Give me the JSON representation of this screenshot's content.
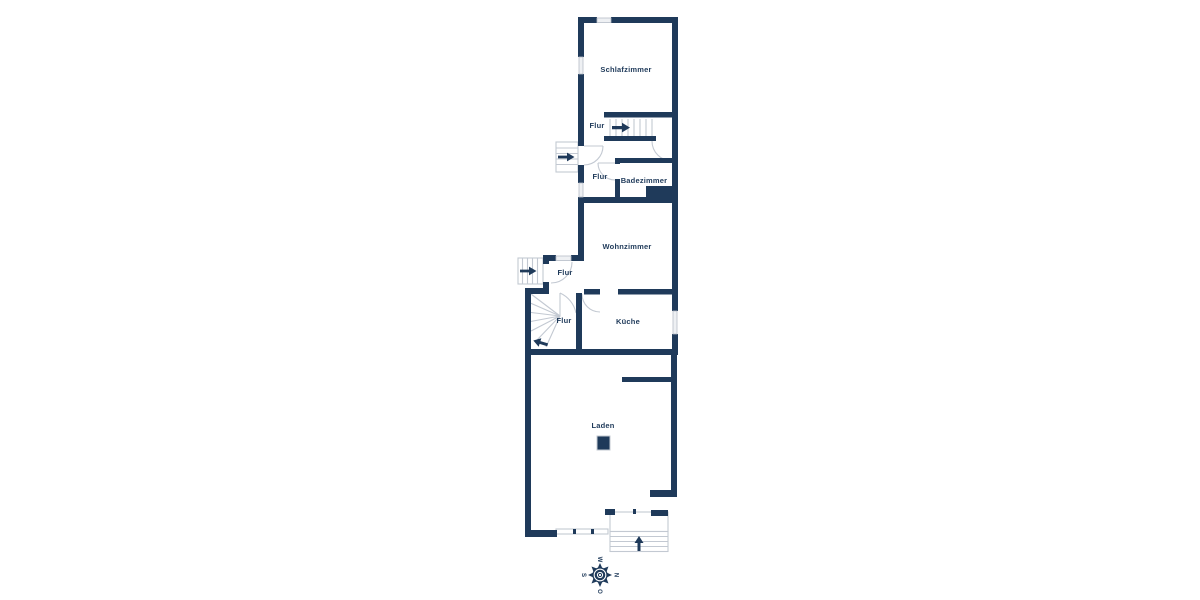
{
  "floorplan": {
    "rooms": {
      "schlafzimmer": "Schlafzimmer",
      "flur_upper": "Flur",
      "flur_bad": "Flur",
      "badezimmer": "Badezimmer",
      "wohnzimmer": "Wohnzimmer",
      "flur_entry": "Flur",
      "flur_stairs": "Flur",
      "kueche": "Küche",
      "laden": "Laden"
    },
    "compass": {
      "top": "W",
      "right": "N",
      "bottom": "O",
      "left": "S"
    },
    "colors": {
      "wall": "#1f3a5a",
      "stair_line": "#c3c9d2",
      "window_fill": "#eef0f3",
      "window_stroke": "#b6bdc7",
      "label_text": "#1f3a5a",
      "background": "#ffffff"
    }
  }
}
